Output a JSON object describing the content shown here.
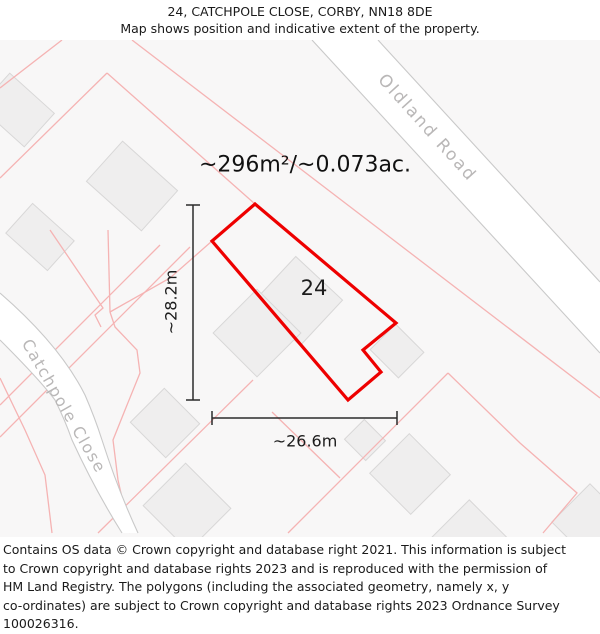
{
  "header": {
    "line1": "24, CATCHPOLE CLOSE, CORBY, NN18 8DE",
    "line2": "Map shows position and indicative extent of the property."
  },
  "map": {
    "area_label": "~296m²/~0.073ac.",
    "plot_number": "24",
    "dimensions": {
      "height": "~28.2m",
      "width": "~26.6m"
    },
    "roads": [
      {
        "name": "Oldland Road"
      },
      {
        "name": "Catchpole Close"
      }
    ],
    "colors": {
      "property_outline": "#ee0000",
      "parcel_line": "#f5b3b3",
      "road_edge": "#c9c9c9",
      "road_fill": "#ffffff",
      "road_label": "#b9b7b7",
      "building_fill": "#efeeee",
      "building_stroke": "#d8d7d7",
      "map_bg": "#f8f7f7"
    }
  },
  "footer": {
    "lines": [
      "Contains OS data © Crown copyright and database right 2021. This information is subject",
      "to Crown copyright and database rights 2023 and is reproduced with the permission of",
      "HM Land Registry. The polygons (including the associated geometry, namely x, y",
      "co-ordinates) are subject to Crown copyright and database rights 2023 Ordnance Survey",
      "100026316."
    ]
  }
}
